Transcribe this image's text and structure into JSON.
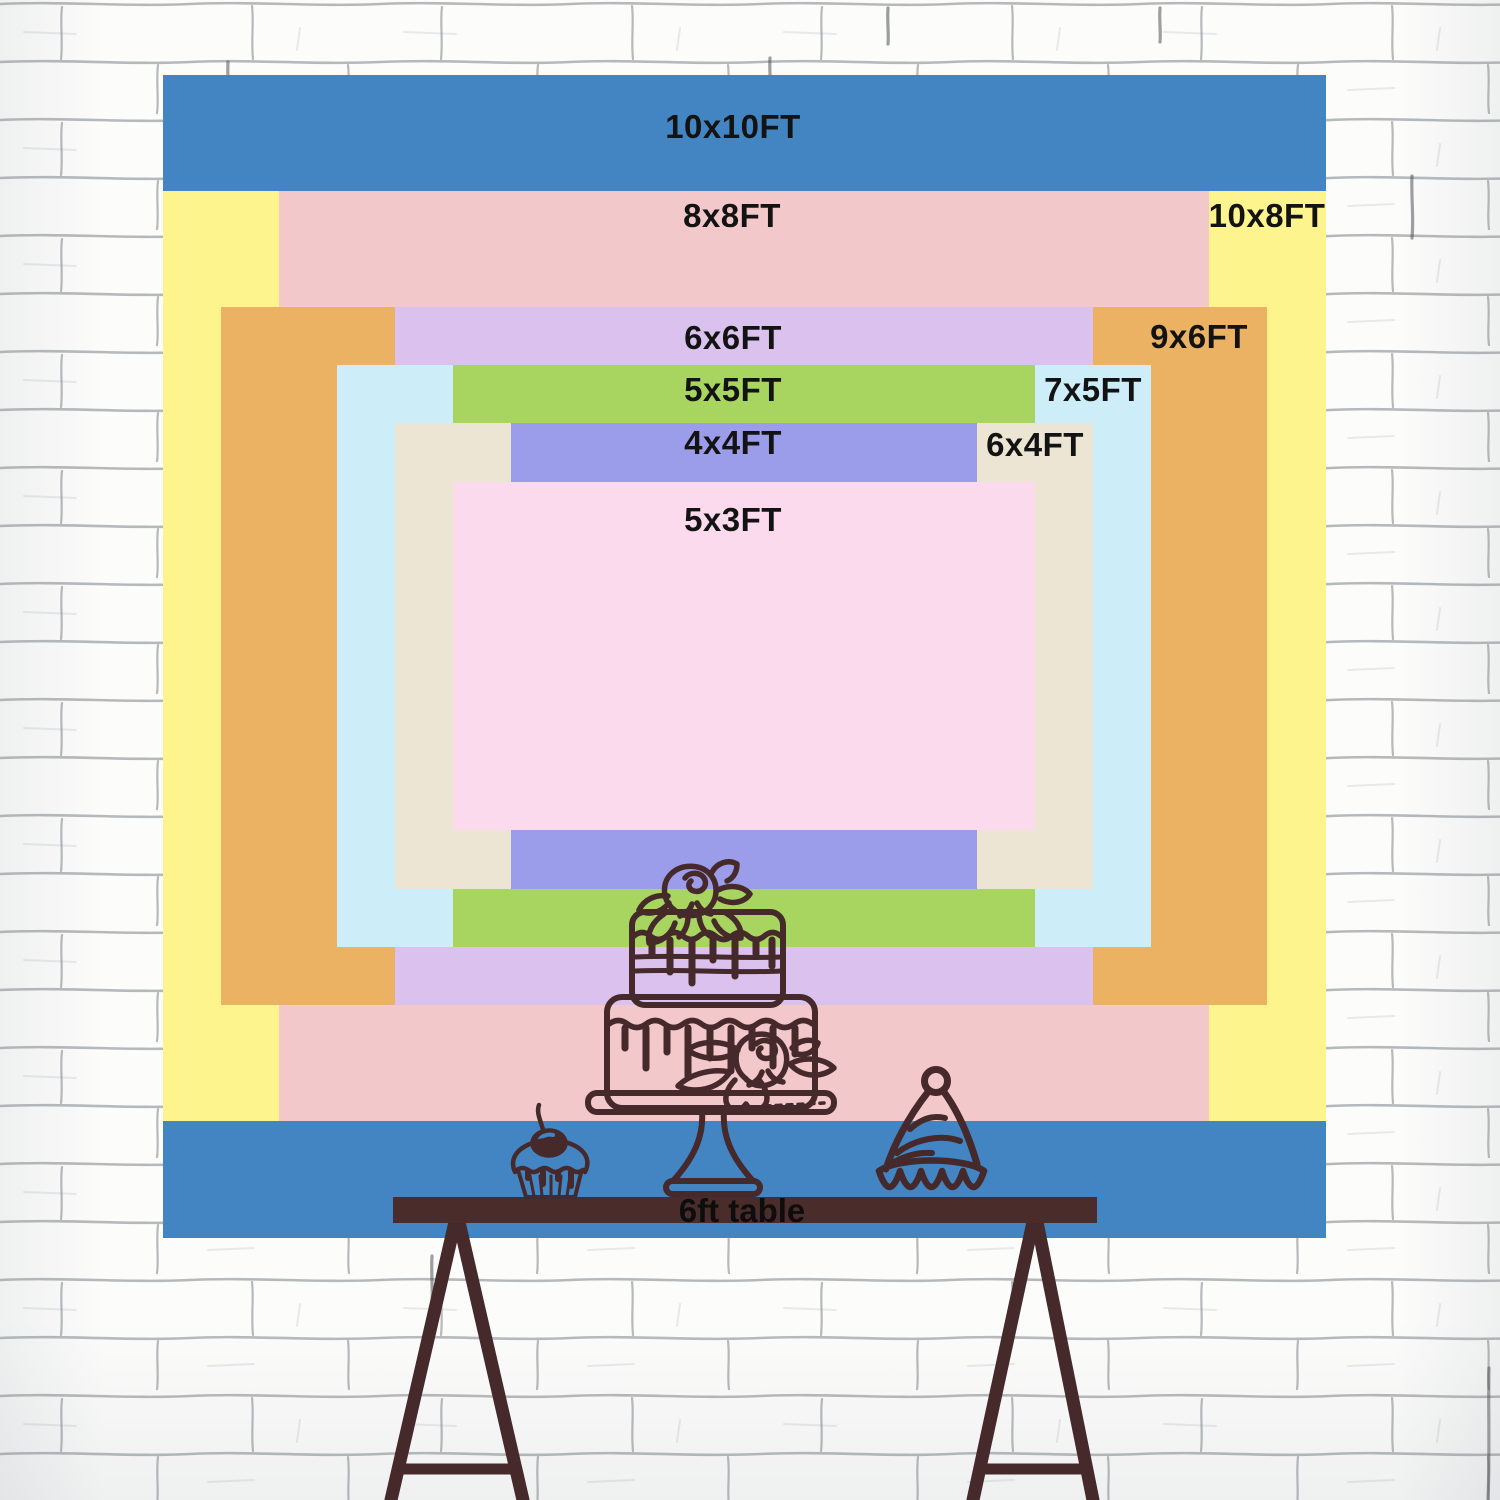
{
  "chart": {
    "unit": "FT",
    "px_per_ft": 116.3,
    "center_x": 744,
    "center_y": 656,
    "label_color": "#131313",
    "sizes": [
      {
        "label": "10x10FT",
        "w_ft": 10,
        "h_ft": 10,
        "color": "#4285c2",
        "label_x": 733,
        "label_y": 127
      },
      {
        "label": "10x8FT",
        "w_ft": 10,
        "h_ft": 8,
        "color": "#fdf48e",
        "label_x": 1267,
        "label_y": 216
      },
      {
        "label": "8x8FT",
        "w_ft": 8,
        "h_ft": 8,
        "color": "#f3c8ca",
        "label_x": 732,
        "label_y": 216
      },
      {
        "label": "9x6FT",
        "w_ft": 9,
        "h_ft": 6,
        "color": "#ecb264",
        "label_x": 1199,
        "label_y": 337
      },
      {
        "label": "6x6FT",
        "w_ft": 6,
        "h_ft": 6,
        "color": "#dbc2ee",
        "label_x": 733,
        "label_y": 338
      },
      {
        "label": "7x5FT",
        "w_ft": 7,
        "h_ft": 5,
        "color": "#cdeef9",
        "label_x": 1093,
        "label_y": 390
      },
      {
        "label": "5x5FT",
        "w_ft": 5,
        "h_ft": 5,
        "color": "#a7d55f",
        "label_x": 733,
        "label_y": 390
      },
      {
        "label": "6x4FT",
        "w_ft": 6,
        "h_ft": 4,
        "color": "#ece5d3",
        "label_x": 1035,
        "label_y": 445
      },
      {
        "label": "4x4FT",
        "w_ft": 4,
        "h_ft": 4,
        "color": "#9c9dea",
        "label_x": 733,
        "label_y": 443
      },
      {
        "label": "5x3FT",
        "w_ft": 5,
        "h_ft": 3,
        "color": "#fcdaed",
        "label_x": 733,
        "label_y": 520
      }
    ]
  },
  "table": {
    "label": "6ft table",
    "color": "#4a2d2b"
  },
  "illustration": {
    "line_color": "#46292a",
    "items": [
      "cupcake",
      "tiered-cake",
      "party-hat"
    ]
  },
  "wall": {
    "brick_color": "#fcfcfb",
    "mortar_color": "#6f767e"
  }
}
